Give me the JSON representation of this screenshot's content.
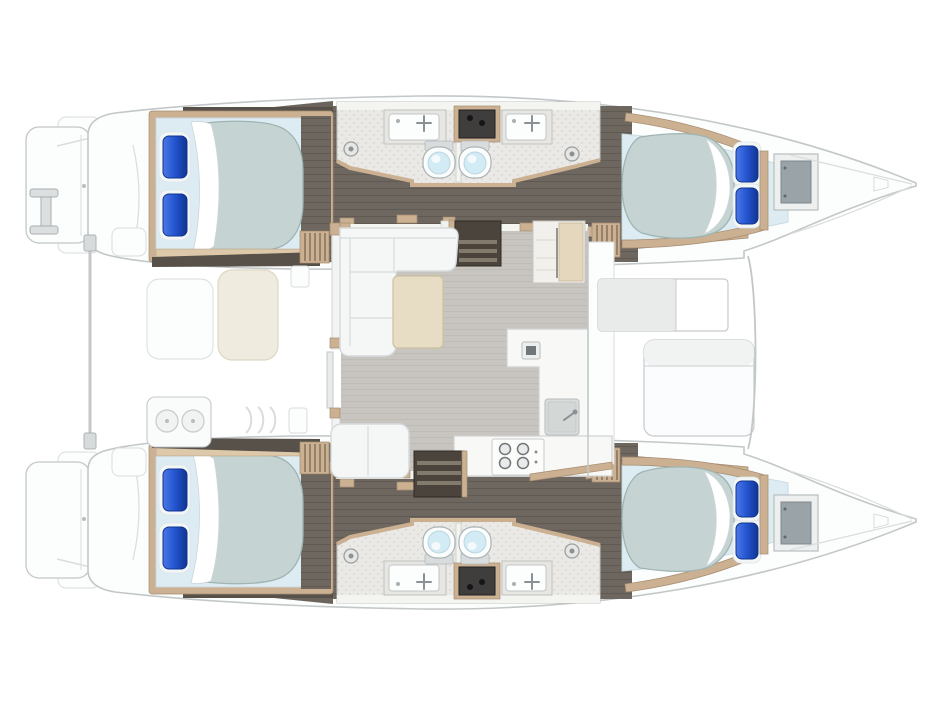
{
  "title": "Catamaran yacht deck plan — top view, bow to the right",
  "colors": {
    "hull_outline": "#c3c7c8",
    "deck": "#fcfdfd",
    "deck_line": "#dadddd",
    "floor_dark": "#6e675f",
    "floor_dark_line": "#605a52",
    "dark_strip": "#57514a",
    "wood": "#cbb091",
    "wood_dark": "#a68d72",
    "wood_light": "#ddc9a9",
    "bed_platform": "#ddecf2",
    "bed_platform_edge": "#c9d9df",
    "mattress": "#c5d4d2",
    "mattress_edge": "#9fb4b3",
    "sheet": "#ffffff",
    "sheet_edge": "#ccd6d8",
    "pillow": "#2353cf",
    "pillow_light": "#4d79e6",
    "pillow_dark": "#10358f",
    "pillow_case": "#f2f6f7",
    "bath_wall": "#f4f4f1",
    "bath_floor": "#eae9e5",
    "bath_speck": "#c9c9c4",
    "toilet_body": "#fbfdfd",
    "toilet_bowl": "#d3ebf4",
    "fixture": "#8a9094",
    "locker_dark": "#3f3e3c",
    "steps_dark": "#4a443d",
    "steps_tread": "#837a6e",
    "slat_line": "#6b5d4c",
    "salon_floor": "#c8c5c0",
    "salon_floor_line": "#bdbab4",
    "sofa": "#f5f7f7",
    "sofa_seam": "#d5dadc",
    "table_wood": "#e7ddc5",
    "table_edge": "#cfc0a0",
    "bench_cream": "#efebdf",
    "bench_cream_edge": "#ded7c2",
    "counter": "#f8f8f6",
    "counter_edge": "#cfd2d2",
    "sink_gray": "#d9dcdb",
    "burner": "#6f7578",
    "pad_gray": "#e9ebeb",
    "hatch_gray": "#9aa3a7",
    "hatch_frame": "#eef0f0",
    "ladder": "#dcdfe0",
    "ladder_edge": "#a9aeb0",
    "beam": "#c3c7c8"
  },
  "layout": {
    "view": "top-down floor plan, bow pointing right",
    "hulls": [
      "port (top)",
      "starboard (bottom)"
    ],
    "per_hull": {
      "aft_cabin": {
        "bed": "double",
        "pillows": 2
      },
      "heads": [
        {
          "fixtures": [
            "shower drain",
            "sink with faucet",
            "toilet"
          ]
        },
        {
          "fixtures": [
            "toilet",
            "sink with faucet",
            "shower drain"
          ]
        }
      ],
      "midship_locker": {
        "knobs": 2
      },
      "forward_cabin": {
        "bed": "double",
        "pillows": 2
      },
      "bow_locker": 1,
      "companionway_steps": 2
    },
    "salon": {
      "items": [
        "L-shaped sofa",
        "coffee table",
        "aft bench",
        "refrigerator cabinet",
        "L-shaped galley counter",
        "small appliance",
        "galley sink",
        "four-burner cooktop",
        "companionway stair port",
        "companionway stair starboard",
        "sliding aft door"
      ]
    },
    "aft_cockpit": {
      "items": [
        "aft crossbeam",
        "boarding ladder",
        "transom platform port",
        "transom platform starboard",
        "cockpit seat",
        "cockpit table",
        "wet bar with twin sinks",
        "cockpit steps",
        "side lockers"
      ]
    },
    "foredeck": {
      "items": [
        "sun pad",
        "forward seat",
        "deck edge"
      ]
    }
  }
}
